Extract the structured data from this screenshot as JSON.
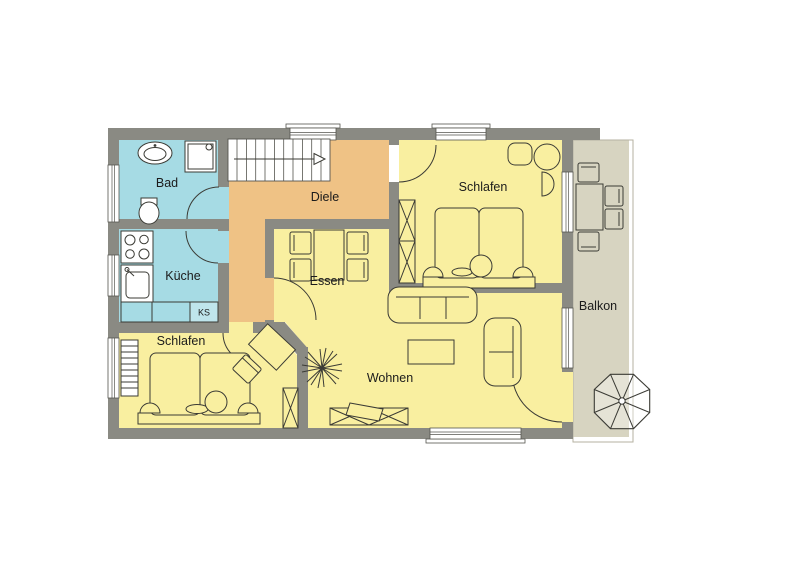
{
  "plan": {
    "type": "apartment-floor-plan",
    "rooms": {
      "bad": {
        "label": "Bad",
        "color": "#a6dbe4"
      },
      "kueche": {
        "label": "Küche",
        "color": "#a6dbe4"
      },
      "ks": {
        "label": "KS",
        "color": "#a6dbe4"
      },
      "diele": {
        "label": "Diele",
        "color": "#efc285"
      },
      "essen": {
        "label": "Essen",
        "color": "#f9efa0"
      },
      "schlafen_top": {
        "label": "Schlafen",
        "color": "#f9efa0"
      },
      "schlafen_bottom": {
        "label": "Schlafen",
        "color": "#f9efa0"
      },
      "wohnen": {
        "label": "Wohnen",
        "color": "#f9efa0"
      },
      "balkon": {
        "label": "Balkon",
        "color": "#d7d4c1"
      }
    },
    "colors": {
      "wall": "#8a8a83",
      "background": "#ffffff",
      "outline": "#3b3b35",
      "window": "#ffffff"
    }
  }
}
